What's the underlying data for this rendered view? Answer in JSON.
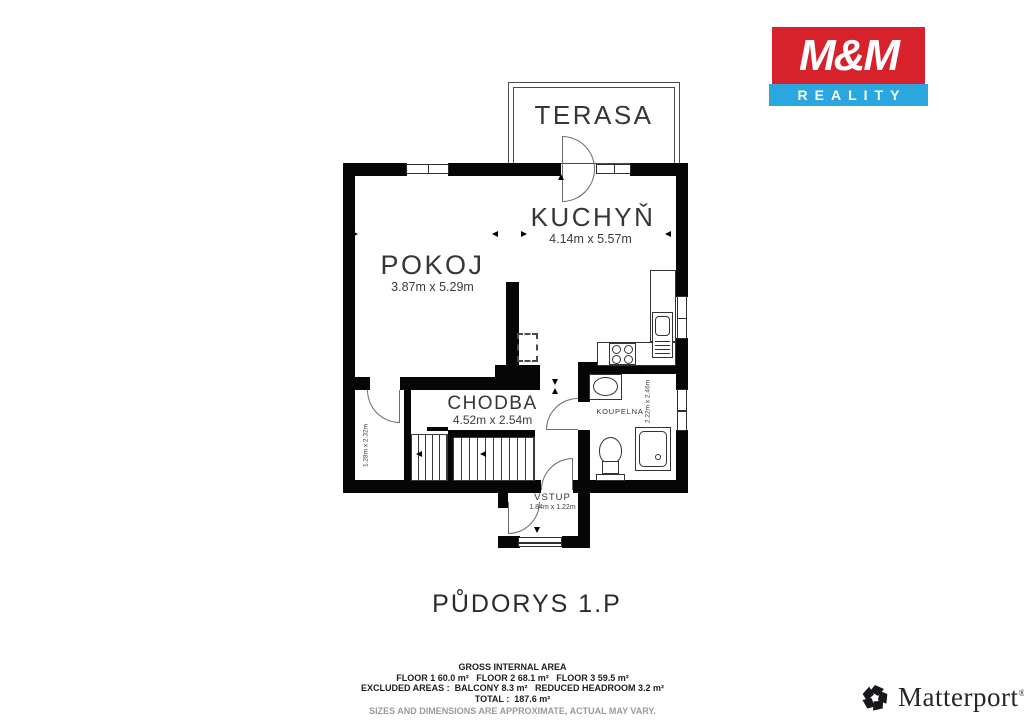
{
  "branding": {
    "mm": {
      "name": "M&M",
      "reality": "REALITY",
      "red": "#d7222c",
      "blue": "#2ba7df"
    },
    "matterport": {
      "name": "Matterport",
      "reg": "®"
    }
  },
  "floorplan": {
    "title": "PŮDORYS 1.P",
    "rooms": {
      "terasa": {
        "name": "TERASA"
      },
      "kuchyn": {
        "name": "KUCHYŇ",
        "dims": "4.14m x 5.57m"
      },
      "pokoj": {
        "name": "POKOJ",
        "dims": "3.87m x 5.29m"
      },
      "chodba": {
        "name": "CHODBA",
        "dims": "4.52m x 2.54m"
      },
      "koupelna": {
        "name": "KOUPELNA",
        "dims": "2.22m x 2.46m"
      },
      "vstup": {
        "name": "VSTUP",
        "dims": "1.84m x 1.22m"
      },
      "satna": {
        "dims": "1.28m x 2.32m"
      }
    }
  },
  "summary": {
    "heading": "GROSS INTERNAL AREA",
    "floors": "FLOOR 1 60.0 m²   FLOOR 2 68.1 m²   FLOOR 3 59.5 m²",
    "excluded": "EXCLUDED AREAS :  BALCONY 8.3 m²   REDUCED HEADROOM 3.2 m²",
    "total": "TOTAL :  187.6 m²",
    "disclaimer": "SIZES AND DIMENSIONS ARE APPROXIMATE, ACTUAL MAY VARY."
  }
}
